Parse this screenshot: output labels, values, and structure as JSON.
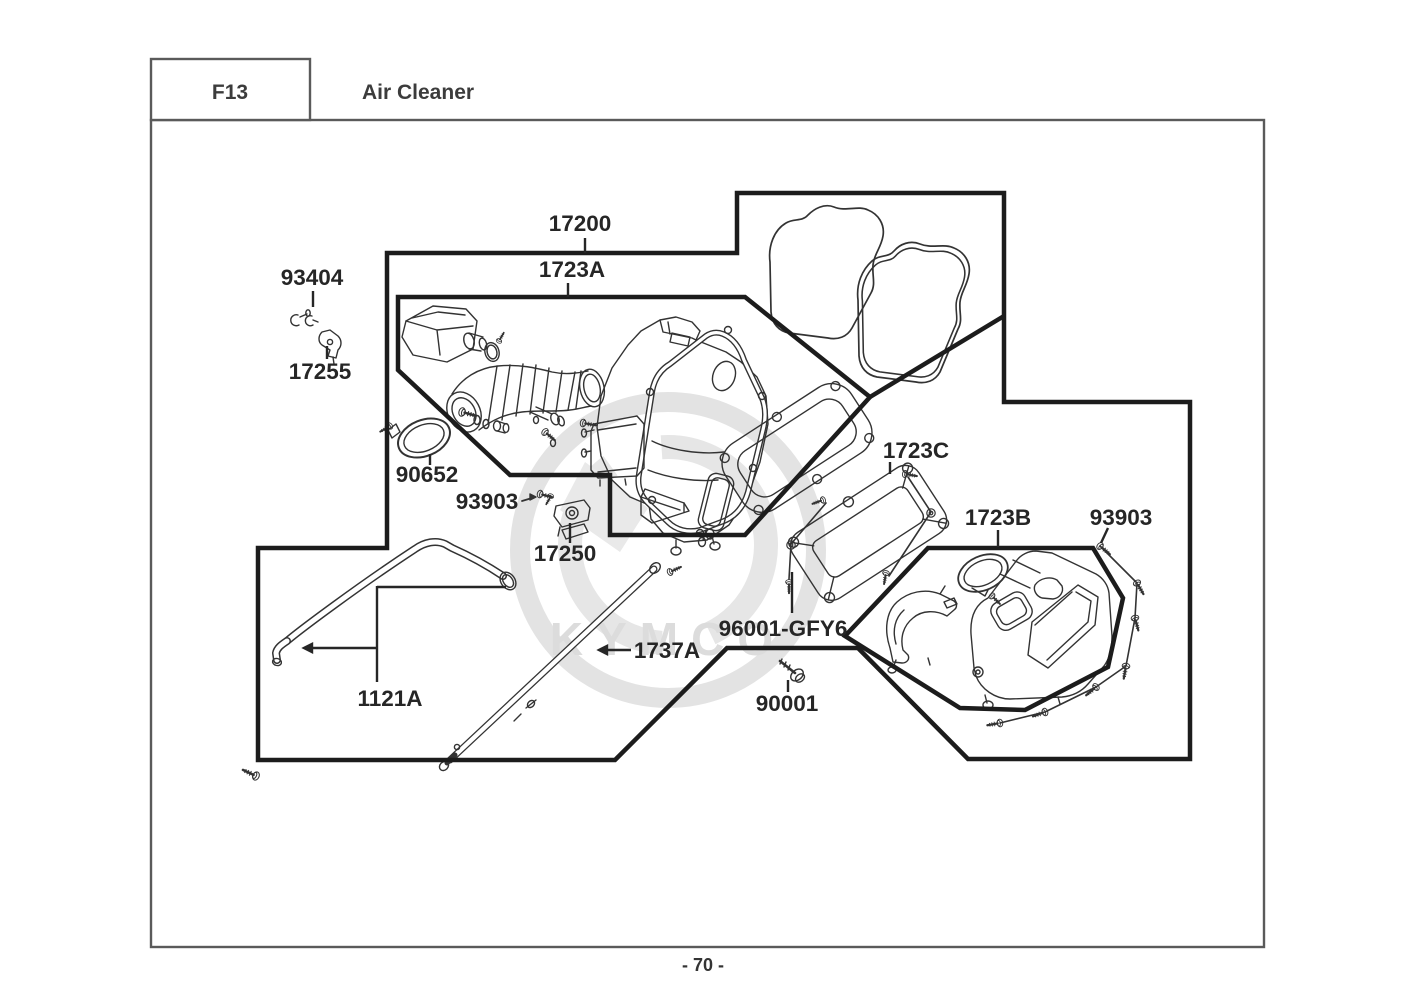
{
  "header": {
    "section_code": "F13",
    "section_title": "Air Cleaner"
  },
  "footer": {
    "page_number": "- 70 -"
  },
  "watermark": {
    "brand": "KYMCO"
  },
  "diagram": {
    "title": "Air Cleaner exploded parts view",
    "labels": [
      {
        "text": "17200"
      },
      {
        "text": "1723A"
      },
      {
        "text": "93404"
      },
      {
        "text": "17255"
      },
      {
        "text": "90652"
      },
      {
        "text": "93903"
      },
      {
        "text": "17250"
      },
      {
        "text": "1723C"
      },
      {
        "text": "1723B"
      },
      {
        "text": "93903"
      },
      {
        "text": "96001-GFY6"
      },
      {
        "text": "1737A"
      },
      {
        "text": "90001"
      },
      {
        "text": "1121A"
      }
    ]
  }
}
